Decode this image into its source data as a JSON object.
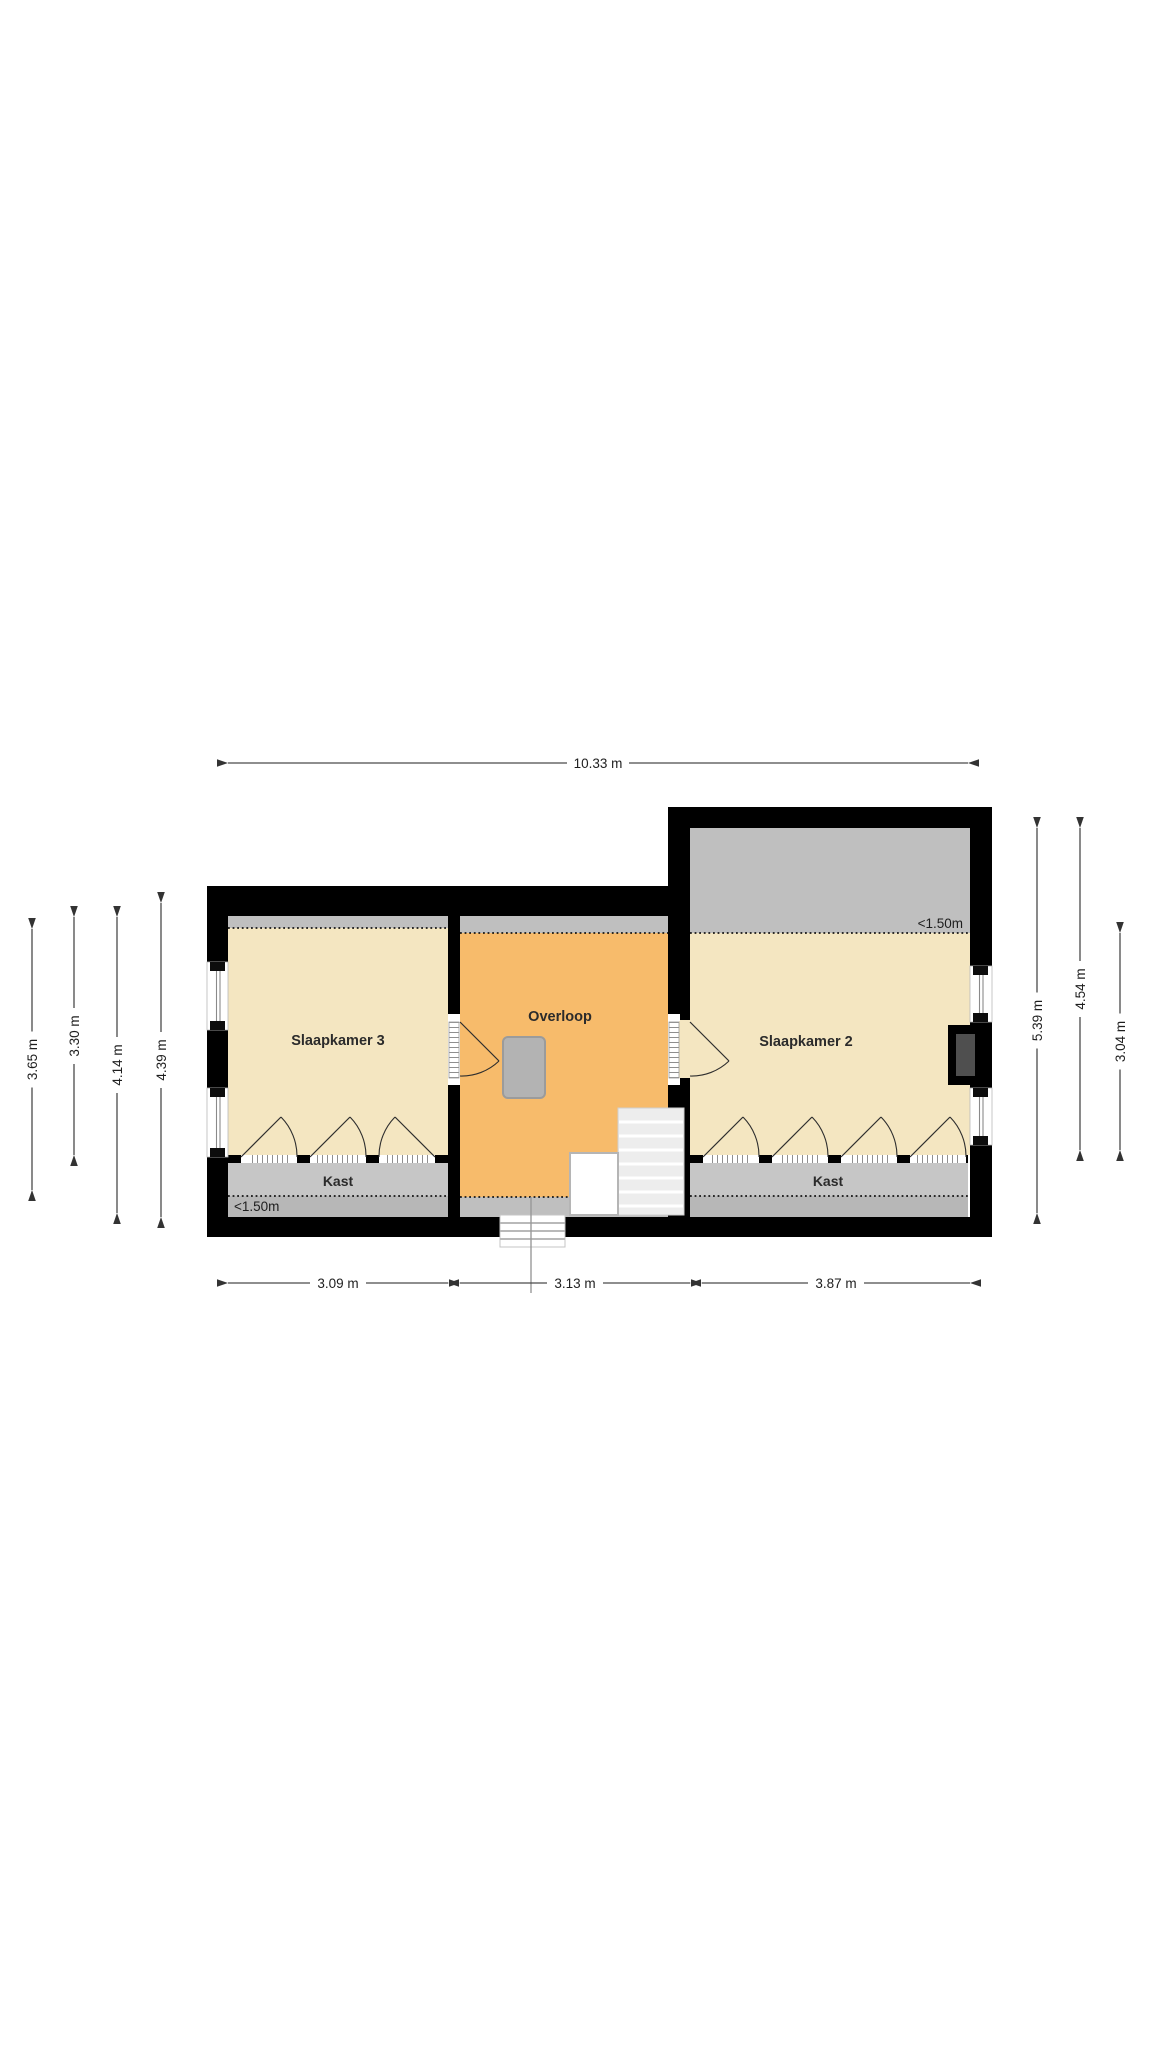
{
  "plan": {
    "type": "floorplan",
    "rooms": {
      "slaapkamer3": "Slaapkamer 3",
      "overloop": "Overloop",
      "slaapkamer2": "Slaapkamer 2",
      "kast_left": "Kast",
      "kast_right": "Kast"
    },
    "annotations": {
      "low_ceiling_left": "<1.50m",
      "low_ceiling_right": "<1.50m"
    },
    "dimensions": {
      "top": "10.33 m",
      "bottom": [
        "3.09 m",
        "3.13 m",
        "3.87 m"
      ],
      "left": [
        "3.65 m",
        "3.30 m",
        "4.14 m",
        "4.39 m"
      ],
      "right": [
        "5.39 m",
        "4.54 m",
        "3.04 m"
      ]
    },
    "colors": {
      "wall": "#000000",
      "bedroom_floor": "#F4E6C1",
      "landing_floor": "#F7BB6B",
      "low_ceiling_zone": "#BFBFBF",
      "closet_zone": "#C6C6C6",
      "closet_zone_dark": "#B7B7B7",
      "stairs": "#EDEDED",
      "flue": "#B3B3B3",
      "fireplace_inner": "#4F4F4F",
      "dimension_line": "#4A4A4A",
      "text": "#222222"
    }
  }
}
